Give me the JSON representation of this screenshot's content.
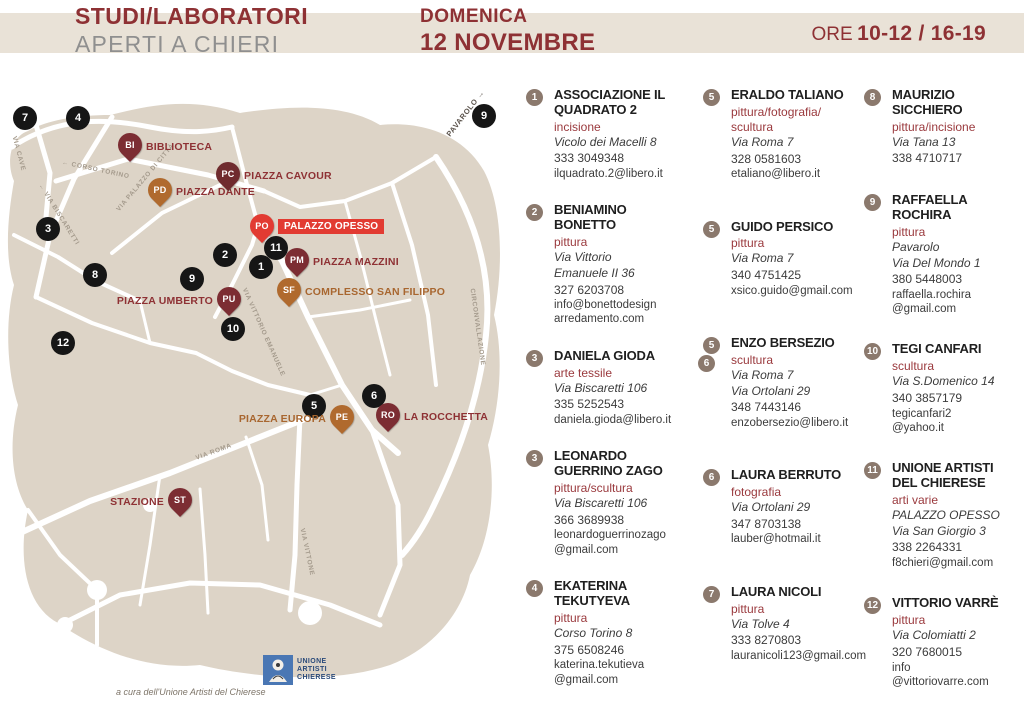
{
  "header": {
    "title_line1": "STUDI/LABORATORI",
    "title_line2": "APERTI A CHIERI",
    "date_line1": "DOMENICA",
    "date_line2": "12 NOVEMBRE",
    "hours_label": "ORE",
    "hours_value": "10-12 / 16-19"
  },
  "colors": {
    "dark_red": "#8e3134",
    "orange_brown": "#b06a2e",
    "maroon_pin": "#7c2d33",
    "bright_red": "#e23b32",
    "band_beige": "#e9e2d7",
    "land_beige": "#ddd4c7",
    "badge_taupe": "#8b796d",
    "marker_black": "#161616"
  },
  "map": {
    "external_label": "PAVAROLO →",
    "credit": "a cura dell'Unione Artisti del Chierese",
    "logo": {
      "line1": "UNIONE",
      "line2": "ARTISTI",
      "line3": "CHIERESE"
    },
    "markers": [
      {
        "n": "7",
        "x": 25,
        "y": 33
      },
      {
        "n": "4",
        "x": 78,
        "y": 33
      },
      {
        "n": "3",
        "x": 48,
        "y": 144
      },
      {
        "n": "8",
        "x": 95,
        "y": 190
      },
      {
        "n": "12",
        "x": 63,
        "y": 258
      },
      {
        "n": "2",
        "x": 225,
        "y": 170
      },
      {
        "n": "11",
        "x": 276,
        "y": 163
      },
      {
        "n": "1",
        "x": 261,
        "y": 182
      },
      {
        "n": "9",
        "x": 192,
        "y": 194
      },
      {
        "n": "10",
        "x": 233,
        "y": 244
      },
      {
        "n": "5",
        "x": 314,
        "y": 321
      },
      {
        "n": "6",
        "x": 374,
        "y": 311
      },
      {
        "n": "9",
        "x": 484,
        "y": 31
      }
    ],
    "pins": [
      {
        "code": "BI",
        "label": "BIBLIOTECA",
        "x": 130,
        "y": 63,
        "color": "maroon",
        "side": "right",
        "label_color": "red",
        "boxed": false
      },
      {
        "code": "PD",
        "label": "PIAZZA DANTE",
        "x": 160,
        "y": 108,
        "color": "orange",
        "side": "right",
        "label_color": "red",
        "boxed": false
      },
      {
        "code": "PC",
        "label": "PIAZZA CAVOUR",
        "x": 228,
        "y": 92,
        "color": "dark",
        "side": "right",
        "label_color": "red",
        "boxed": false
      },
      {
        "code": "PO",
        "label": "PALAZZO OPESSO",
        "x": 262,
        "y": 144,
        "color": "red",
        "side": "right",
        "label_color": "red",
        "boxed": true
      },
      {
        "code": "PM",
        "label": "PIAZZA MAZZINI",
        "x": 297,
        "y": 178,
        "color": "maroon",
        "side": "right",
        "label_color": "red",
        "boxed": false
      },
      {
        "code": "SF",
        "label": "COMPLESSO SAN FILIPPO",
        "x": 289,
        "y": 208,
        "color": "orange",
        "side": "right",
        "label_color": "orange",
        "boxed": false
      },
      {
        "code": "PU",
        "label": "PIAZZA UMBERTO",
        "x": 229,
        "y": 217,
        "color": "maroon",
        "side": "left",
        "label_color": "red",
        "boxed": false
      },
      {
        "code": "PE",
        "label": "PIAZZA EUROPA",
        "x": 342,
        "y": 335,
        "color": "orange",
        "side": "left",
        "label_color": "orange",
        "boxed": false
      },
      {
        "code": "RO",
        "label": "LA ROCCHETTA",
        "x": 388,
        "y": 333,
        "color": "maroon",
        "side": "right",
        "label_color": "red",
        "boxed": false
      },
      {
        "code": "ST",
        "label": "STAZIONE",
        "x": 180,
        "y": 418,
        "color": "maroon",
        "side": "left",
        "label_color": "red",
        "boxed": false
      }
    ],
    "streets": [
      {
        "name": "VIA CAVE",
        "x": 14,
        "y": 48,
        "angle": 75
      },
      {
        "name": "← CORSO TORINO",
        "x": 62,
        "y": 74,
        "angle": 12
      },
      {
        "name": "← VIA BISCARETTI",
        "x": 40,
        "y": 96,
        "angle": 58
      },
      {
        "name": "VIA PALAZZO DI CITTÀ",
        "x": 118,
        "y": 122,
        "angle": -50
      },
      {
        "name": "VIA VITTORIO EMANUELE",
        "x": 244,
        "y": 200,
        "angle": 66
      },
      {
        "name": "CIRCONVALLAZIONE",
        "x": 472,
        "y": 200,
        "angle": 82
      },
      {
        "name": "VIA ROMA",
        "x": 196,
        "y": 370,
        "angle": -20
      },
      {
        "name": "VIA VITTONE",
        "x": 302,
        "y": 440,
        "angle": 78
      }
    ]
  },
  "listing": {
    "columns": [
      {
        "entries": [
          {
            "numbers": [
              "1"
            ],
            "name": "ASSOCIAZIONE IL QUADRATO 2",
            "category": [
              "incisione"
            ],
            "address": [
              "Vicolo dei Macelli 8"
            ],
            "phone": "333 3049348",
            "email": [
              "ilquadrato.2@libero.it"
            ]
          },
          {
            "numbers": [
              "2"
            ],
            "name": "BENIAMINO BONETTO",
            "category": [
              "pittura"
            ],
            "address": [
              "Via Vittorio",
              "Emanuele II 36"
            ],
            "phone": "327 6203708",
            "email": [
              "info@bonettodesign",
              "arredamento.com"
            ]
          },
          {
            "numbers": [
              "3"
            ],
            "name": "DANIELA GIODA",
            "category": [
              "arte tessile"
            ],
            "address": [
              "Via Biscaretti 106"
            ],
            "phone": "335 5252543",
            "email": [
              "daniela.gioda@libero.it"
            ]
          },
          {
            "numbers": [
              "3"
            ],
            "name": "LEONARDO GUERRINO ZAGO",
            "category": [
              "pittura/scultura"
            ],
            "address": [
              "Via Biscaretti 106"
            ],
            "phone": "366 3689938",
            "email": [
              "leonardoguerrinozago",
              "@gmail.com"
            ]
          },
          {
            "numbers": [
              "4"
            ],
            "name": "EKATERINA TEKUTYEVA",
            "category": [
              "pittura"
            ],
            "address": [
              "Corso Torino 8"
            ],
            "phone": "375 6508246",
            "email": [
              "katerina.tekutieva",
              "@gmail.com"
            ]
          }
        ]
      },
      {
        "entries": [
          {
            "numbers": [
              "5"
            ],
            "name": "ERALDO TALIANO",
            "category": [
              "pittura/fotografia/",
              "scultura"
            ],
            "address": [
              "Via Roma 7"
            ],
            "phone": "328 0581603",
            "email": [
              "etaliano@libero.it"
            ]
          },
          {
            "numbers": [
              "5"
            ],
            "name": "GUIDO PERSICO",
            "category": [
              "pittura"
            ],
            "address": [
              "Via Roma 7"
            ],
            "phone": "340 4751425",
            "email": [
              "xsico.guido@gmail.com"
            ]
          },
          {
            "numbers": [
              "5",
              "6"
            ],
            "name": "ENZO BERSEZIO",
            "category": [
              "scultura"
            ],
            "address": [
              "Via Roma 7",
              "Via Ortolani 29"
            ],
            "phone": "348 7443146",
            "email": [
              "enzobersezio@libero.it"
            ]
          },
          {
            "numbers": [
              "6"
            ],
            "name": "LAURA BERRUTO",
            "category": [
              "fotografia"
            ],
            "address": [
              "Via Ortolani 29"
            ],
            "phone": "347 8703138",
            "email": [
              "lauber@hotmail.it"
            ]
          },
          {
            "numbers": [
              "7"
            ],
            "name": "LAURA NICOLI",
            "category": [
              "pittura"
            ],
            "address": [
              "Via Tolve 4"
            ],
            "phone": "333 8270803",
            "email": [
              "lauranicoli123@gmail.com"
            ]
          }
        ]
      },
      {
        "entries": [
          {
            "numbers": [
              "8"
            ],
            "name": "MAURIZIO SICCHIERO",
            "category": [
              "pittura/incisione"
            ],
            "address": [
              "Via Tana 13"
            ],
            "phone": "338 4710717",
            "email": []
          },
          {
            "numbers": [
              "9"
            ],
            "name": "RAFFAELLA ROCHIRA",
            "category": [
              "pittura"
            ],
            "address": [
              "Pavarolo",
              "Via Del Mondo 1"
            ],
            "phone": "380 5448003",
            "email": [
              "raffaella.rochira",
              "@gmail.com"
            ]
          },
          {
            "numbers": [
              "10"
            ],
            "name": "TEGI CANFARI",
            "category": [
              "scultura"
            ],
            "address": [
              "Via S.Domenico 14"
            ],
            "phone": "340 3857179",
            "email": [
              "tegicanfari2",
              "@yahoo.it"
            ]
          },
          {
            "numbers": [
              "11"
            ],
            "name": "UNIONE ARTISTI DEL CHIERESE",
            "category": [
              "arti varie"
            ],
            "address": [
              "PALAZZO OPESSO",
              "Via San Giorgio 3"
            ],
            "phone": "338 2264331",
            "email": [
              "f8chieri@gmail.com"
            ]
          },
          {
            "numbers": [
              "12"
            ],
            "name": "VITTORIO VARRÈ",
            "category": [
              "pittura"
            ],
            "address": [
              "Via Colomiatti 2"
            ],
            "phone": "320 7680015",
            "email": [
              "info",
              "@vittoriovarre.com"
            ]
          }
        ]
      }
    ]
  }
}
